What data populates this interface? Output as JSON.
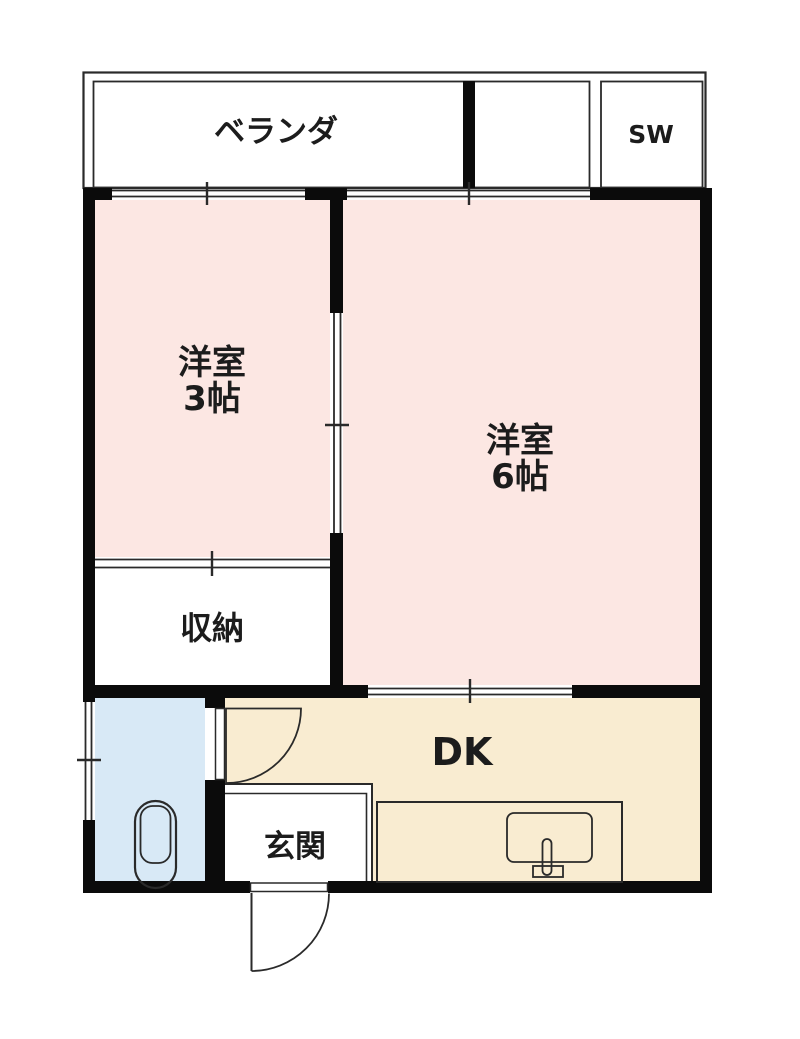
{
  "plan": {
    "veranda": {
      "label": "ベランダ"
    },
    "sw_closet": {
      "label": "SW"
    },
    "western_room_3": {
      "name": "洋室",
      "size": "3帖"
    },
    "western_room_6": {
      "name": "洋室",
      "size": "6帖"
    },
    "closet": {
      "label": "収納"
    },
    "dining_kitchen": {
      "label": "DK"
    },
    "entrance": {
      "label": "玄関"
    }
  },
  "colors": {
    "room_fill": "#fce7e3",
    "dk_fill": "#f9ecd1",
    "bathroom_fill": "#d8e9f6",
    "wall": "#0b0b0b"
  }
}
